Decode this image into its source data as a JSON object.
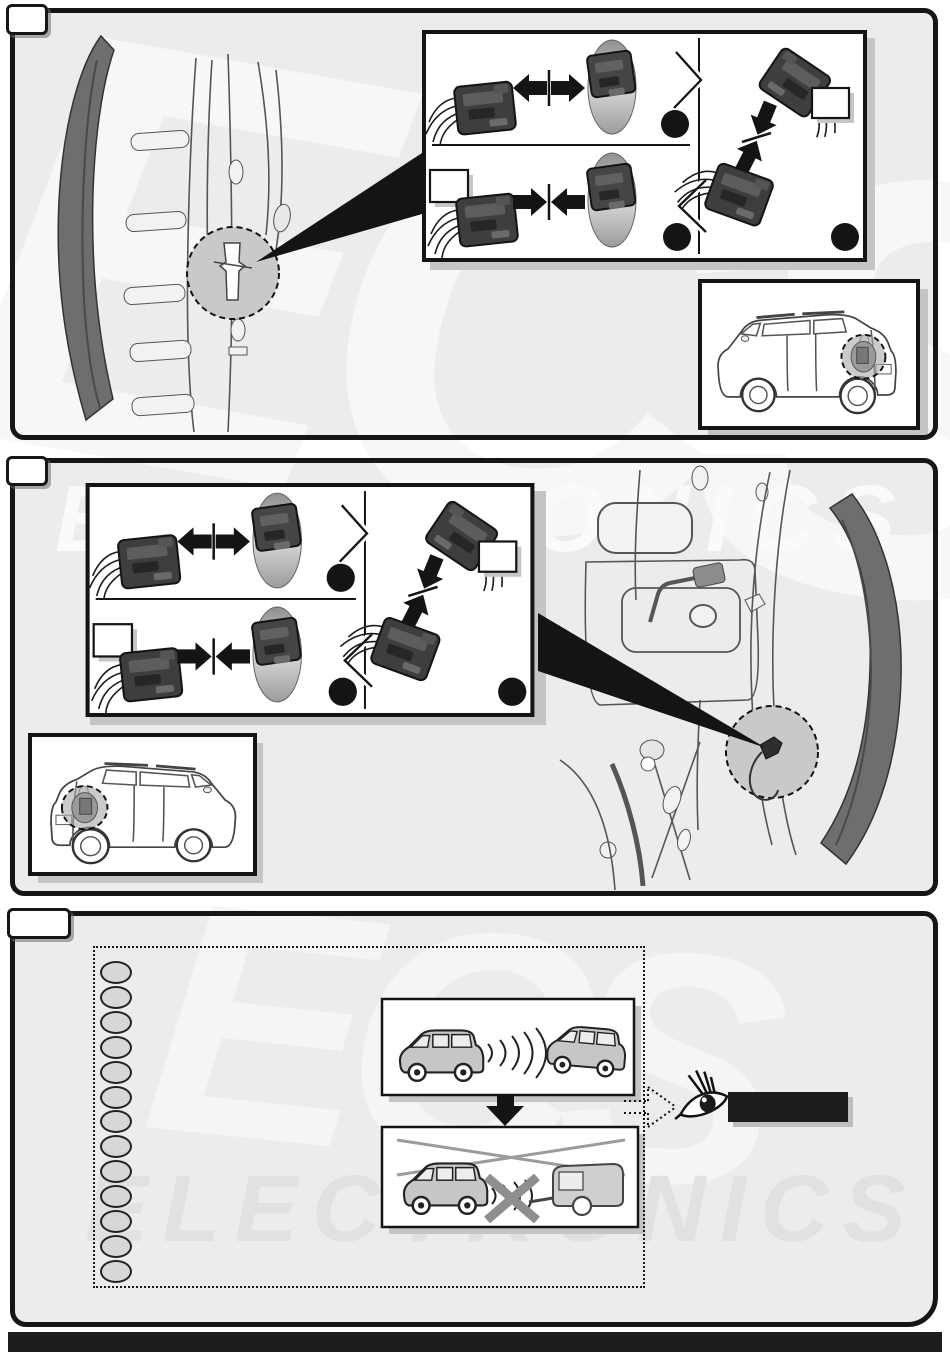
{
  "page": {
    "width": 950,
    "height": 1369,
    "background": "#ffffff",
    "panel_fill": "#ececec",
    "ink_color": "#161616",
    "footer_bar_color": "#1d1d1d",
    "footer_bar_text": ""
  },
  "watermark": {
    "brand": "ECS",
    "word": "ELECTRONICS"
  },
  "panels": [
    {
      "name": "step-panel-1",
      "tab_label": "",
      "detail_box": {
        "side_callout_label": "",
        "right_callout_label": "",
        "redacted_step_dots": 3
      },
      "vehicle_inset": {
        "view": "suv-rear-right",
        "highlight": "tail-light-wiring-area"
      }
    },
    {
      "name": "step-panel-2",
      "tab_label": "",
      "detail_box": {
        "side_callout_label": "",
        "right_callout_label": "",
        "redacted_step_dots": 3
      },
      "vehicle_inset": {
        "view": "suv-rear-left",
        "highlight": "tail-light-wiring-area"
      }
    },
    {
      "name": "step-panel-3",
      "tab_label": "",
      "note_list_items": [
        "",
        "",
        "",
        "",
        "",
        "",
        "",
        "",
        "",
        "",
        "",
        "",
        ""
      ],
      "figures": [
        {
          "name": "parking-distance-sensors-active"
        },
        {
          "name": "parking-sensors-disabled-when-towing"
        }
      ],
      "see_reference": {
        "icon": "eye-icon",
        "redacted_text": ""
      }
    }
  ]
}
